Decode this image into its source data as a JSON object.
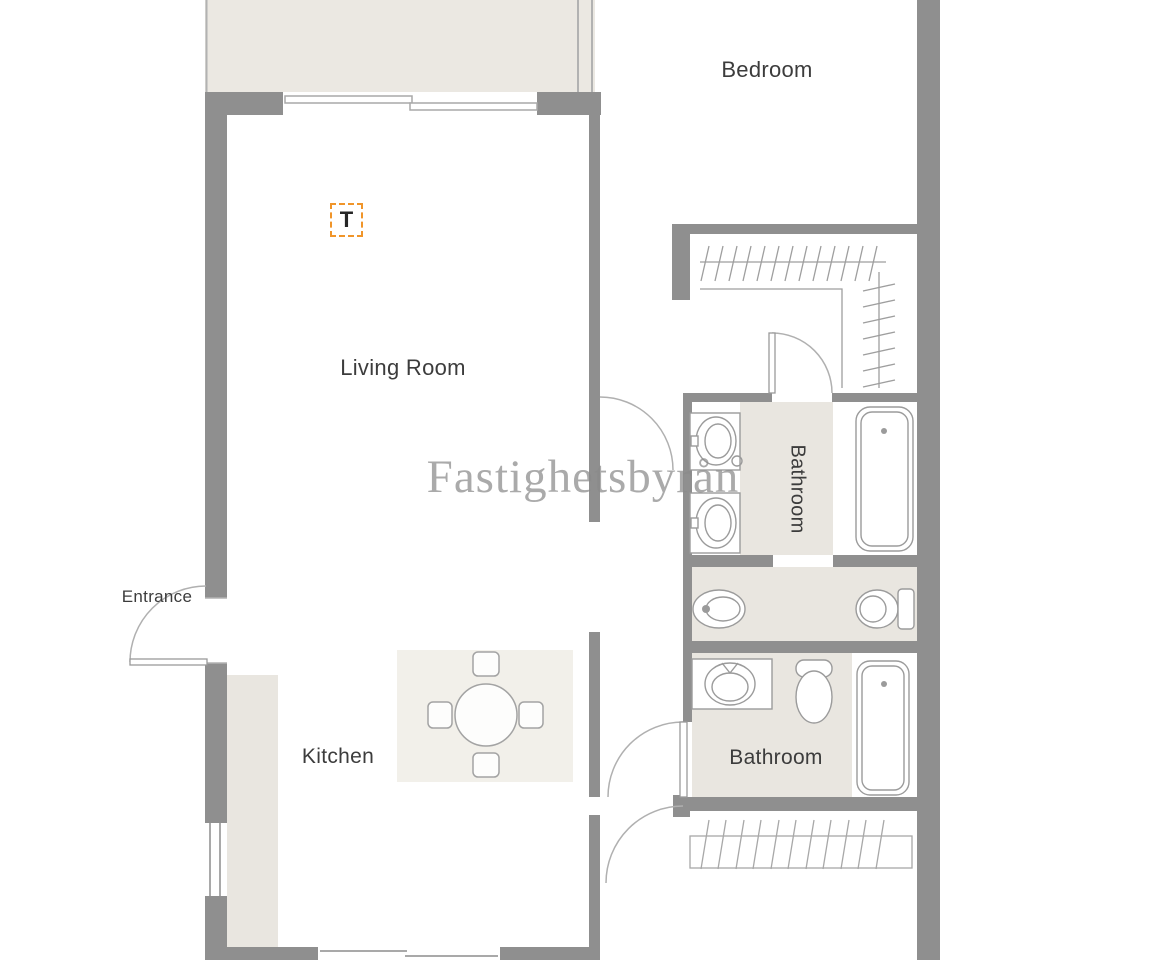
{
  "watermark": {
    "text": "Fastighetsbyrån",
    "color": "#8a8a8a"
  },
  "labels": {
    "living_room": "Living Room",
    "kitchen": "Kitchen",
    "bedroom": "Bedroom",
    "entrance": "Entrance",
    "bathroom_upper": "Bathroom",
    "bathroom_lower": "Bathroom"
  },
  "markers": {
    "tv_outlet": "T"
  },
  "colors": {
    "wall": "#8f8f8f",
    "floor_accent": "#e9e6e0",
    "fixture_line": "#9b9b9b",
    "thin_line": "#b2b2b2",
    "marker_orange": "#f0952a",
    "label_text": "#3c3c3c",
    "watermark_gray": "#8a8a8a"
  }
}
